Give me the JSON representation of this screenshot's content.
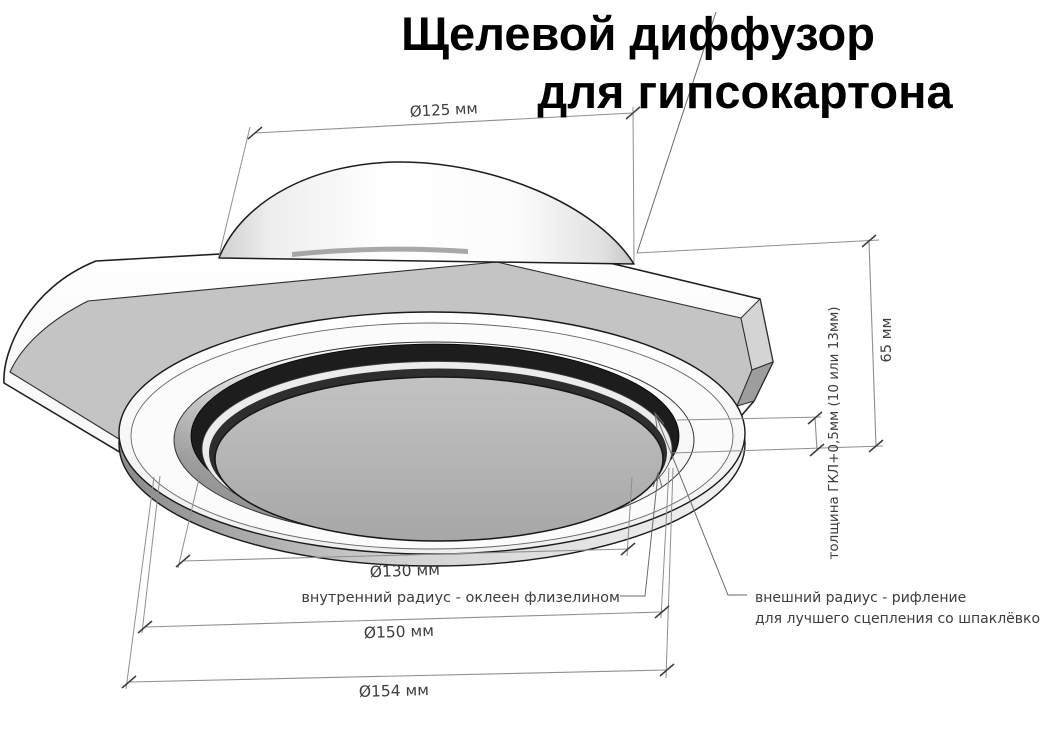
{
  "title": {
    "line1": "Щелевой диффузор",
    "line2": "для гипсокартона"
  },
  "dimensions": {
    "top_diameter": {
      "label": "Ø125 мм"
    },
    "inner_diameter": {
      "label": "Ø130 мм"
    },
    "flange_diameter": {
      "label": "Ø150 мм"
    },
    "outer_diameter": {
      "label": "Ø154 мм"
    },
    "height": {
      "label": "65 мм"
    },
    "panel_thickness": {
      "label": "толщина ГКЛ+0,5мм (10 или 13мм)"
    }
  },
  "annotations": {
    "inner_radius": {
      "label": "внутренний радиус - оклеен флизелином"
    },
    "outer_radius": {
      "line1": "внешний радиус - рифление",
      "line2": "для лучшего сцепления со шпаклёвкой"
    }
  },
  "colors": {
    "plate_face": "#c4c4c4",
    "slot_ring": "#1d1d1d",
    "dimension_line": "#8f8f8f",
    "label_text": "#3d3d3d",
    "title_text": "#000000",
    "background": "#ffffff"
  }
}
